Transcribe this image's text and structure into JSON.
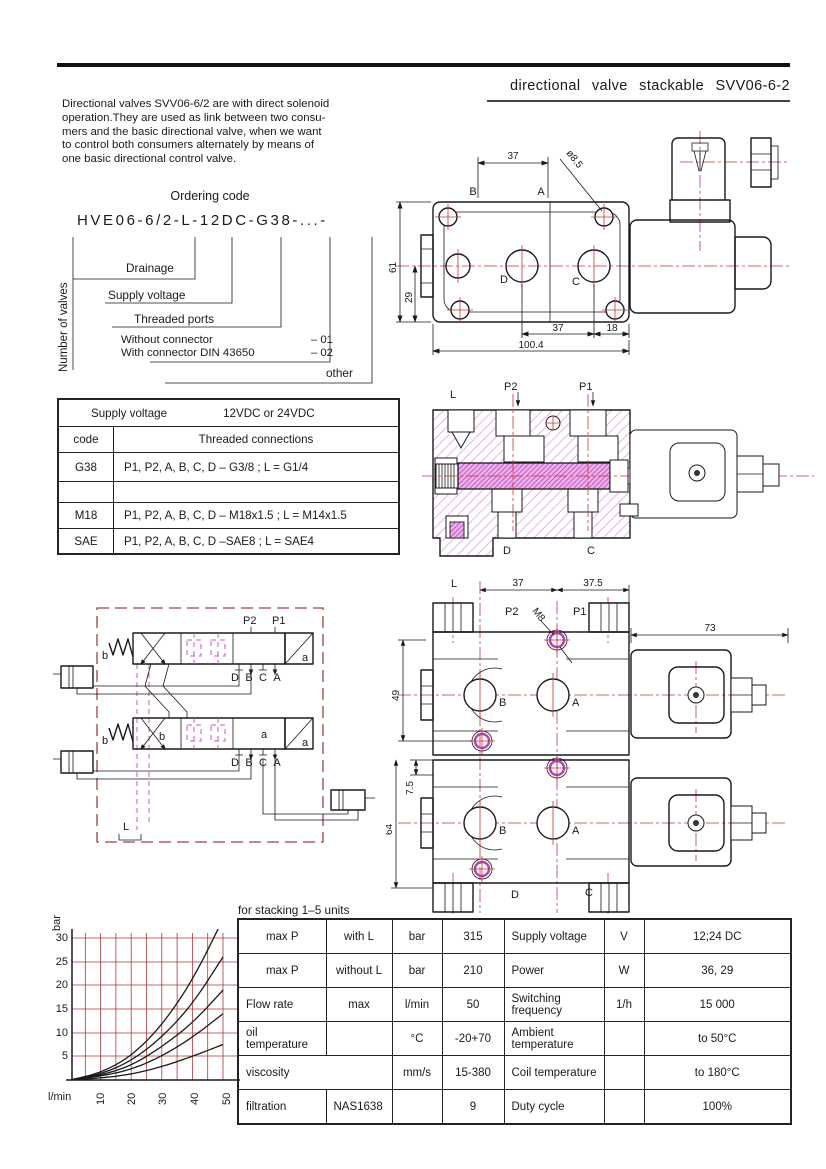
{
  "header": {
    "title": "directional valve stackable SVV06-6-2"
  },
  "intro": {
    "lines": [
      "Directional valves SVV06-6/2 are with direct solenoid",
      "operation.They are used as link between two consu-",
      "mers and the basic directional valve, when we want",
      "to control both consumers alternately by means of",
      "one basic directional control valve."
    ]
  },
  "ordering": {
    "title": "Ordering code",
    "code": "HVE06-6/2-L-12DC-G38-...-",
    "number_of_valves": "Number of valves",
    "drainage": "Drainage",
    "supply_voltage": "Supply voltage",
    "threaded_ports": "Threaded ports",
    "without_label": "Without connector",
    "without_code": "– 01",
    "with_label": "With connector DIN 43650",
    "with_code": "– 02",
    "other": "other"
  },
  "supply_table": {
    "title": "Supply voltage",
    "value": "12VDC or 24VDC",
    "col1": "code",
    "col2": "Threaded connections",
    "rows": [
      {
        "code": "G38",
        "desc": "P1, P2, A, B, C, D – G3/8 ; L = G1/4"
      },
      {
        "code": "",
        "desc": ""
      },
      {
        "code": "M18",
        "desc": "P1, P2, A, B, C, D – M18x1.5 ; L = M14x1.5"
      },
      {
        "code": "SAE",
        "desc": "P1, P2, A, B, C, D –SAE8 ; L = SAE4"
      }
    ]
  },
  "drawing_top": {
    "dim_37_top": "37",
    "dia": "ø8.5",
    "port_b": "B",
    "port_a": "A",
    "dim_61": "61",
    "dim_29": "29",
    "port_d": "D",
    "port_c": "C",
    "dim_37_bot": "37",
    "dim_18": "18",
    "dim_100": "100.4"
  },
  "drawing_section": {
    "l": "L",
    "p2": "P2",
    "p1": "P1",
    "d": "D",
    "c": "C"
  },
  "schematic": {
    "p2": "P2",
    "p1": "P1",
    "b": "b",
    "a": "a",
    "l": "L",
    "ports": [
      "D",
      "B",
      "C",
      "A"
    ]
  },
  "drawing_stack": {
    "l": "L",
    "p2": "P2",
    "p1": "P1",
    "m8": "M8",
    "dim37": "37",
    "dim375": "37.5",
    "dim73": "73",
    "dim49": "49",
    "dim75": "7.5",
    "dim64": "64",
    "b": "B",
    "a": "A",
    "d": "D",
    "c": "C"
  },
  "chart_data": {
    "type": "line",
    "xlabel": "l/min",
    "ylabel": "bar",
    "x": [
      0,
      10,
      20,
      30,
      40,
      50
    ],
    "xticks": [
      "10",
      "20",
      "30",
      "40",
      "50"
    ],
    "yticks": [
      "5",
      "10",
      "15",
      "20",
      "25",
      "30"
    ],
    "xlim": [
      0,
      55
    ],
    "ylim": [
      0,
      31
    ],
    "grid": true,
    "grid_color": "#b03838",
    "legend": "none",
    "series": [
      {
        "name": "curve-1",
        "values": [
          0,
          1.5,
          5,
          11.5,
          21,
          34
        ]
      },
      {
        "name": "curve-2",
        "values": [
          0,
          1.2,
          4,
          9,
          16,
          26
        ]
      },
      {
        "name": "curve-3",
        "values": [
          0,
          1.0,
          3,
          7,
          12,
          19
        ]
      },
      {
        "name": "curve-4",
        "values": [
          0,
          0.8,
          2.2,
          5,
          9,
          14
        ]
      },
      {
        "name": "curve-5",
        "values": [
          0,
          0.4,
          1.2,
          2.8,
          5,
          7.5
        ]
      }
    ]
  },
  "spec_table": {
    "caption": "for stacking 1–5 units",
    "rows": [
      [
        "max P",
        "with L",
        "bar",
        "315",
        "Supply voltage",
        "V",
        "12;24 DC"
      ],
      [
        "max P",
        "without L",
        "bar",
        "210",
        "Power",
        "W",
        "36, 29"
      ],
      [
        "Flow rate",
        "max",
        "l/min",
        "50",
        "Switching frequency",
        "1/h",
        "15 000"
      ],
      [
        "oil temperature",
        "",
        "°C",
        "-20+70",
        "Ambient temperature",
        "",
        "to 50°C"
      ],
      [
        "viscosity",
        "mm/s",
        "15-380",
        "Coil temperature",
        "",
        "to 180°C"
      ],
      [
        "filtration",
        "NAS1638",
        "",
        "9",
        "Duty cycle",
        "",
        "100%"
      ]
    ]
  }
}
